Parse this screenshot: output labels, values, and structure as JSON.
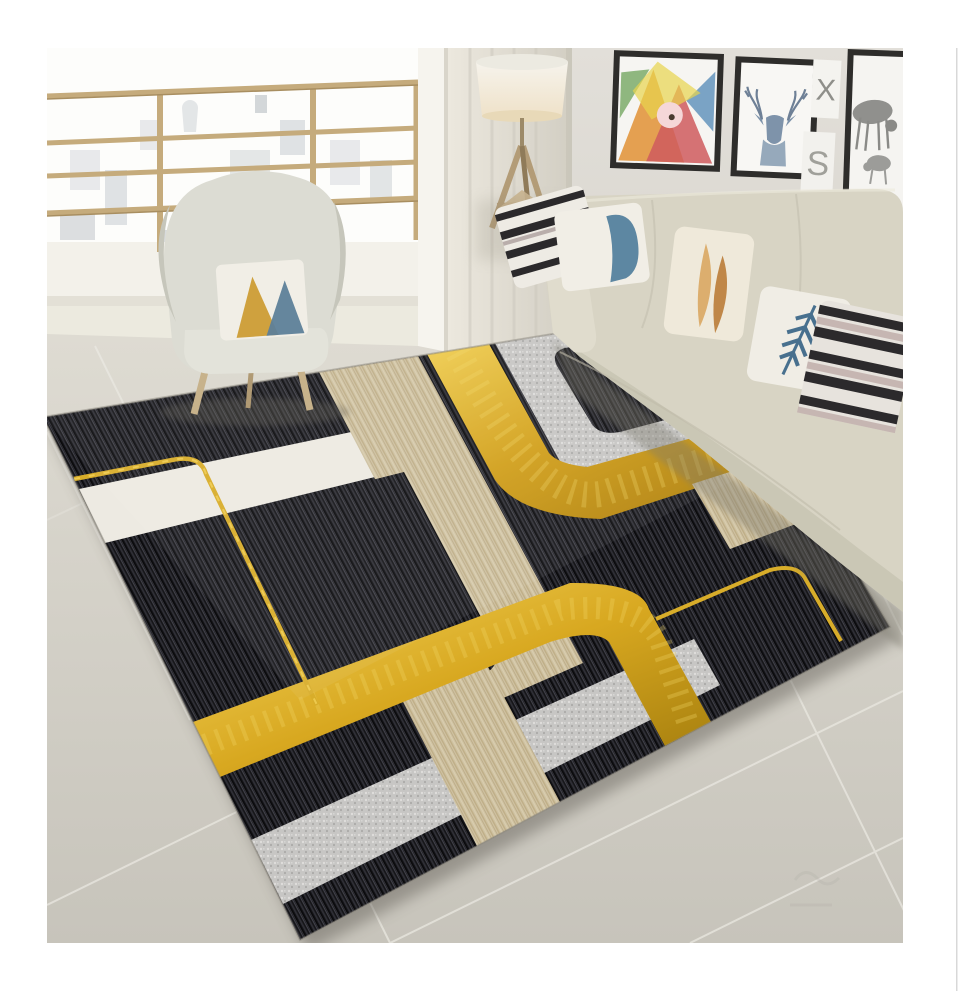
{
  "image": {
    "type": "interior product photo",
    "subject": "black gold geometric area rug",
    "room": "living room with balcony, armchair, floor lamp, sofa and gallery wall"
  },
  "wall_art": {
    "card_x_letter": "X",
    "card_s_letter": "S",
    "frames": [
      "abstract-geometric-art",
      "watercolor-deer-head",
      "letter-card-x",
      "letter-card-s",
      "deer-and-fawn-art"
    ]
  },
  "rug": {
    "style": "abstract geometric with rounded bands",
    "colors": {
      "black": "#17171a",
      "gold": "#d4a017",
      "beige": "#cfc2a2",
      "silver": "#c8c7c5",
      "white": "#edeae2"
    }
  },
  "room_colors": {
    "floor_tile": "#d5d2c9",
    "wall": "#dbd8d2",
    "sofa": "#d8d4c4",
    "armchair": "#dcdcd4",
    "railing_gold": "#c5ab7c",
    "pillow_blue": "#5d87a2",
    "pillow_tan": "#dcae6e"
  }
}
